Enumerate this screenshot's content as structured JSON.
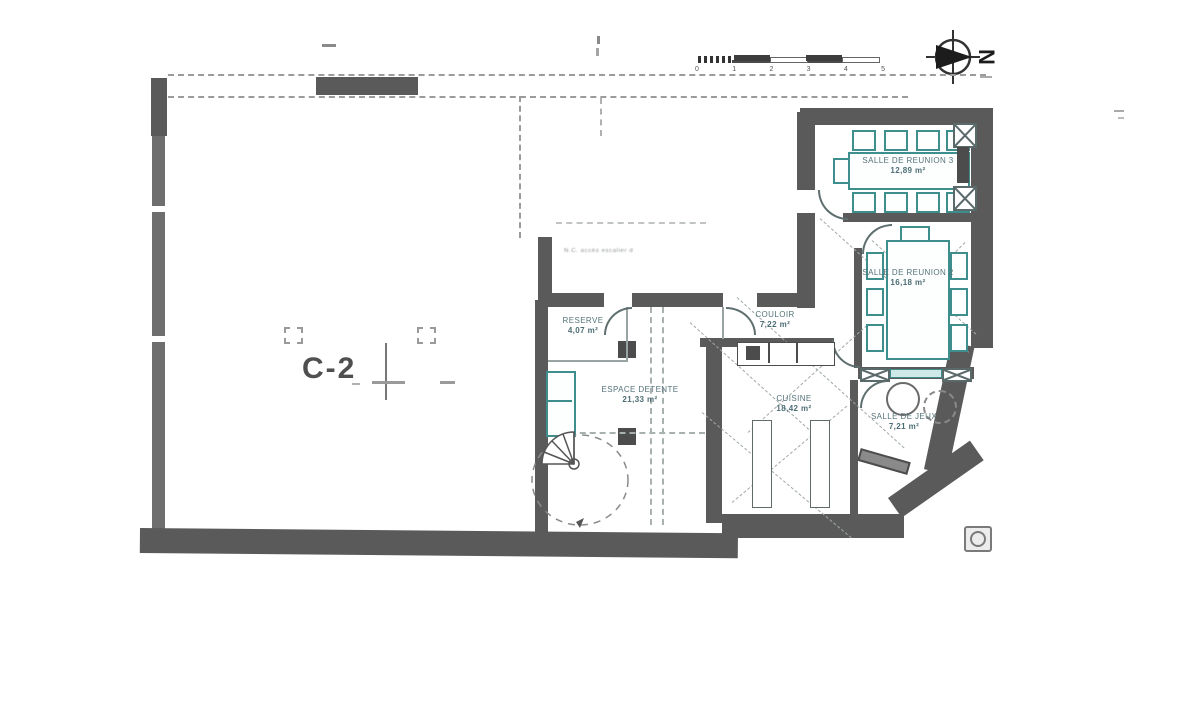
{
  "plan": {
    "unit_label": "C-2",
    "annotation": "N.C. accès escalier d",
    "rooms": [
      {
        "name": "SALLE DE REUNION 3",
        "area": "12,89 m²"
      },
      {
        "name": "SALLE DE REUNION 2",
        "area": "16,18 m²"
      },
      {
        "name": "RESERVE",
        "area": "4,07 m²"
      },
      {
        "name": "COULOIR",
        "area": "7,22 m²"
      },
      {
        "name": "ESPACE DETENTE",
        "area": "21,33 m²"
      },
      {
        "name": "CUISINE",
        "area": "18,42 m²"
      },
      {
        "name": "SALLE DE JEUX",
        "area": "7,21 m²"
      }
    ]
  },
  "scale_bar": {
    "ticks": [
      "0",
      "1",
      "2",
      "3",
      "4",
      "5"
    ]
  },
  "compass": {
    "letter": "N"
  },
  "colors": {
    "wall": "#5a5a5a",
    "furniture": "#3f8e8e",
    "line": "#9aa3a3"
  }
}
